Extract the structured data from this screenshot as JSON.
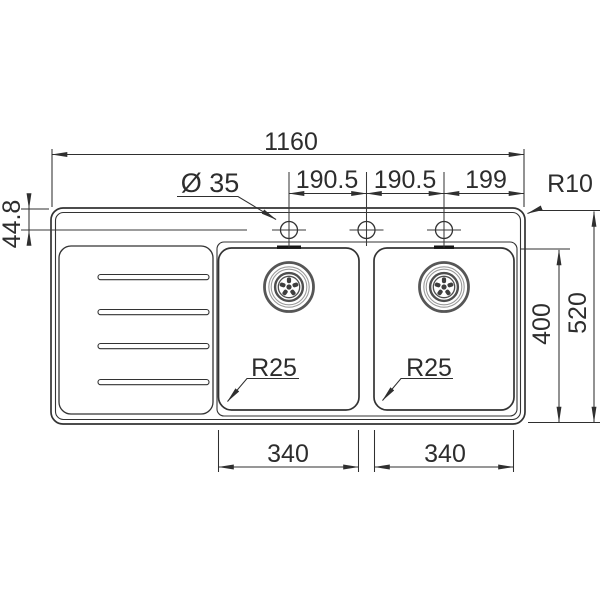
{
  "drawing": {
    "title": "double-bowl-sink-plan-technical-drawing",
    "labels": {
      "overall_width": "1160",
      "hole_diameter": "Ø 35",
      "hole_spacing_left": "190.5",
      "hole_spacing_right": "190.5",
      "hole_edge_offset": "199",
      "corner_radius": "R10",
      "rim_to_hole_center": "44.8",
      "overall_depth": "520",
      "bowl_depth": "400",
      "bowl_width_left": "340",
      "bowl_width_right": "340",
      "bowl_radius_left": "R25",
      "bowl_radius_right": "R25"
    },
    "colors": {
      "background": "#ffffff",
      "line": "#333333",
      "dimension_line": "#2f2f2f",
      "text": "#2d2d2d",
      "drain_ring_dark": "#4e4e4e",
      "drain_ring_light": "#9a9a9a"
    }
  }
}
